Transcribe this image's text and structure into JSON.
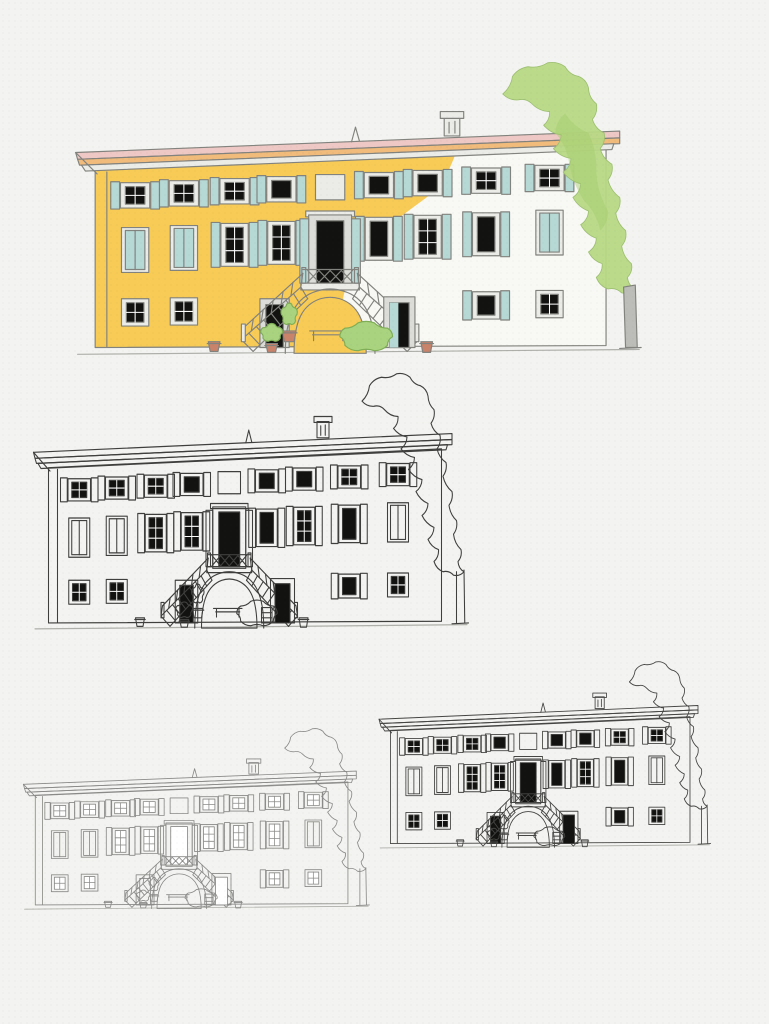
{
  "page": {
    "background": "#f3f3f1",
    "description": "Four study drawings of an Italian villa facade with a central horseshoe double staircase and a tall tree at the right: one watercolor-tinted version and three ink/pencil line versions at decreasing sizes"
  },
  "palette": {
    "wall_yellow": "#f7cb55",
    "wall_white": "#f8f8f5",
    "roof_pink": "#eec8c4",
    "eave_orange": "#f0bb7b",
    "frame_light": "#ebebe8",
    "stone_gray": "#dcdcd8",
    "shutter_blue": "#b7d9d6",
    "glass_dark": "#121210",
    "tree_green": "#b7d884",
    "tree_green_dark": "#a3cc6d",
    "bush_green": "#a9d37f",
    "bush_edge": "#7fae57",
    "pot_terracotta": "#c8836a",
    "trunk_gray": "#bcbcb8",
    "ground_gray": "#aeaeaa"
  },
  "windows": {
    "top": [
      "p",
      "p",
      "p",
      "d",
      "e",
      "d",
      "d",
      "p",
      "p"
    ],
    "middle": [
      "b",
      "b",
      "p",
      "p",
      "D",
      "d",
      "p",
      "d",
      "b"
    ],
    "ground": [
      {
        "col": 0,
        "kind": "p",
        "shutters": false
      },
      {
        "col": 1,
        "kind": "p",
        "shutters": false
      },
      {
        "col": 7,
        "kind": "d",
        "shutters": true
      },
      {
        "col": 8,
        "kind": "p",
        "shutters": false
      }
    ]
  },
  "variants": [
    {
      "id": "watercolor-large",
      "label": "watercolor study",
      "x": 62,
      "y": 55,
      "w": 585,
      "h": 312,
      "colored": true,
      "dark": true,
      "stroke": "#82827e",
      "stroke_width": 1.2
    },
    {
      "id": "ink-medium",
      "label": "ink outline study",
      "x": 23,
      "y": 367,
      "w": 450,
      "h": 273,
      "colored": false,
      "dark": true,
      "stroke": "#3f3f3d",
      "stroke_width": 1.4
    },
    {
      "id": "pencil-small",
      "label": "light pencil study",
      "x": 15,
      "y": 724,
      "w": 358,
      "h": 193,
      "colored": false,
      "dark": false,
      "stroke": "#8a8a88",
      "stroke_width": 1.4
    },
    {
      "id": "ink-small",
      "label": "small ink study",
      "x": 371,
      "y": 657,
      "w": 343,
      "h": 199,
      "colored": false,
      "dark": true,
      "stroke": "#454543",
      "stroke_width": 1.5
    }
  ]
}
